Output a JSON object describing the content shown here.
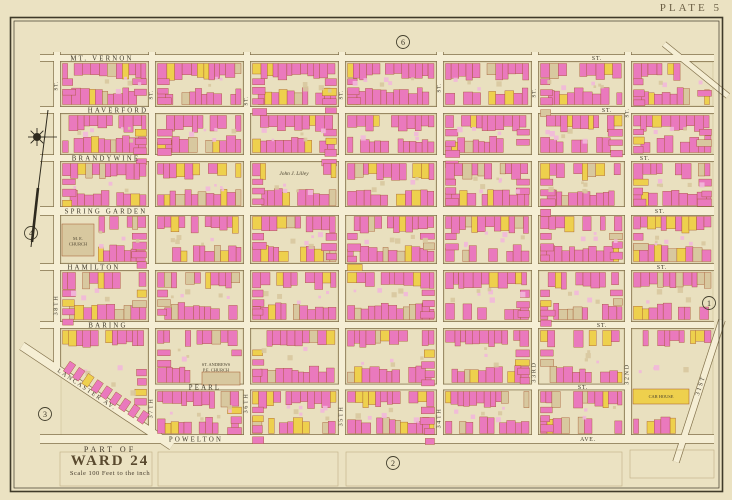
{
  "plate_label": "PLATE 5",
  "title_block": {
    "part_of": "PART OF",
    "ward": "WARD 24",
    "scale": "Scale 100 Feet to the inch"
  },
  "corner_refs": [
    {
      "n": "6",
      "x": 403,
      "y": 42
    },
    {
      "n": "2",
      "x": 393,
      "y": 463
    },
    {
      "n": "1",
      "x": 709,
      "y": 303
    },
    {
      "n": "4",
      "x": 31,
      "y": 233
    },
    {
      "n": "3",
      "x": 45,
      "y": 414
    }
  ],
  "palette": {
    "paper": "#ebe2c2",
    "block": "#e9e0bf",
    "block_line": "#b6a67a",
    "street": "#f5eed4",
    "street_line": "#82714b",
    "ink": "#3c3627",
    "pink": "#ea79bd",
    "pink_light": "#f2b8da",
    "yellow": "#eed04d",
    "tan": "#d8c89f",
    "bldg_line": "#a3562d",
    "frame": "#3f3a29",
    "faint": "#c0b084",
    "compass": "#2e2a1e"
  },
  "buildings": {
    "seed": 20240613,
    "pink_ratio": 0.8,
    "yellow_ratio": 0.12
  },
  "streets": {
    "horizontal": [
      {
        "name": "mt-vernon",
        "label": "MT. VERNON",
        "suffix": "ST.",
        "y": 58,
        "w": 6,
        "x0": 40,
        "x1": 714,
        "label_x": 102,
        "suffix_x": 597
      },
      {
        "name": "haverford",
        "label": "HAVERFORD",
        "suffix": "ST.",
        "y": 110,
        "w": 6,
        "x0": 40,
        "x1": 714,
        "label_x": 118,
        "suffix_x": 607
      },
      {
        "name": "brandywine",
        "label": "BRANDYWINE",
        "suffix": "ST.",
        "y": 158,
        "w": 6,
        "x0": 40,
        "x1": 714,
        "label_x": 106,
        "suffix_x": 645
      },
      {
        "name": "spring-garden",
        "label": "SPRING GARDEN",
        "suffix": "ST.",
        "y": 211,
        "w": 8,
        "x0": 40,
        "x1": 714,
        "label_x": 106,
        "suffix_x": 660
      },
      {
        "name": "hamilton",
        "label": "HAMILTON",
        "suffix": "ST.",
        "y": 267,
        "w": 6,
        "x0": 40,
        "x1": 714,
        "label_x": 94,
        "suffix_x": 662
      },
      {
        "name": "baring",
        "label": "BARING",
        "suffix": "ST.",
        "y": 325,
        "w": 6,
        "x0": 40,
        "x1": 714,
        "label_x": 108,
        "suffix_x": 602
      },
      {
        "name": "pearl",
        "label": "PEARL",
        "suffix": "ST.",
        "y": 387,
        "w": 5,
        "x0": 152,
        "x1": 628,
        "label_x": 205,
        "suffix_x": 583
      },
      {
        "name": "powelton",
        "label": "POWELTON",
        "suffix": "AVE.",
        "y": 439,
        "w": 8,
        "x0": 40,
        "x1": 714,
        "label_x": 196,
        "suffix_x": 588
      }
    ],
    "vertical": [
      {
        "name": "38th",
        "label": "38TH",
        "suffix": "ST.",
        "x": 57,
        "w": 6,
        "y0": 52,
        "y1": 372,
        "suffix_y": 86,
        "label_y": 305
      },
      {
        "name": "37th",
        "label": "37TH",
        "suffix": "ST.",
        "x": 152,
        "w": 6,
        "y0": 52,
        "y1": 443,
        "suffix_y": 95,
        "label_y": 408
      },
      {
        "name": "36th",
        "label": "36TH",
        "suffix": "ST.",
        "x": 247,
        "w": 6,
        "y0": 52,
        "y1": 443,
        "suffix_y": 101,
        "label_y": 403
      },
      {
        "name": "35th",
        "label": "35TH",
        "suffix": "ST.",
        "x": 342,
        "w": 6,
        "y0": 52,
        "y1": 443,
        "suffix_y": 95,
        "label_y": 416
      },
      {
        "name": "34th",
        "label": "34TH",
        "suffix": "ST.",
        "x": 440,
        "w": 6,
        "y0": 52,
        "y1": 443,
        "suffix_y": 88,
        "label_y": 418
      },
      {
        "name": "33rd",
        "label": "33RD",
        "suffix": "ST.",
        "x": 535,
        "w": 6,
        "y0": 52,
        "y1": 443,
        "suffix_y": 93,
        "label_y": 372
      },
      {
        "name": "32nd",
        "label": "32ND",
        "suffix": "ST.",
        "x": 628,
        "w": 6,
        "y0": 52,
        "y1": 443,
        "suffix_y": 113,
        "label_y": 374
      }
    ],
    "diagonal": [
      {
        "name": "lancaster",
        "label": "LANCASTER  AV.",
        "x1": 22,
        "y1": 346,
        "x2": 172,
        "y2": 446,
        "w": 8,
        "label_x": 86,
        "label_y": 391,
        "angle": 34
      },
      {
        "name": "31st",
        "label": "31ST",
        "x1": 722,
        "y1": 320,
        "x2": 676,
        "y2": 462,
        "w": 6,
        "label_x": 702,
        "label_y": 386,
        "angle": -72
      },
      {
        "name": "corner-diagonal",
        "label": "",
        "x1": 664,
        "y1": 44,
        "x2": 728,
        "y2": 96,
        "w": 5
      }
    ]
  },
  "landmarks": [
    {
      "name": "me-church",
      "lines": [
        "M. E.",
        "CHURCH"
      ],
      "x": 78,
      "y": 240,
      "bld": [
        62,
        224,
        32,
        32
      ],
      "fill": "tan"
    },
    {
      "name": "st-andrews-church",
      "lines": [
        "ST. ANDREWS",
        "P.E. CHURCH"
      ],
      "x": 216,
      "y": 366,
      "bld": [
        202,
        372,
        38,
        13
      ],
      "fill": "tan"
    },
    {
      "name": "john-j-lilley",
      "lines": [
        "John J. Lilley"
      ],
      "x": 294,
      "y": 175,
      "italic": true
    },
    {
      "name": "car-house",
      "lines": [
        "CAR HOUSE"
      ],
      "x": 661,
      "y": 398,
      "bld": [
        633,
        389,
        56,
        15
      ],
      "fill": "yellow"
    }
  ],
  "vacant_parcels": [
    [
      60,
      452,
      92,
      34
    ],
    [
      158,
      452,
      180,
      34
    ],
    [
      346,
      452,
      276,
      34
    ],
    [
      630,
      450,
      84,
      28
    ]
  ]
}
